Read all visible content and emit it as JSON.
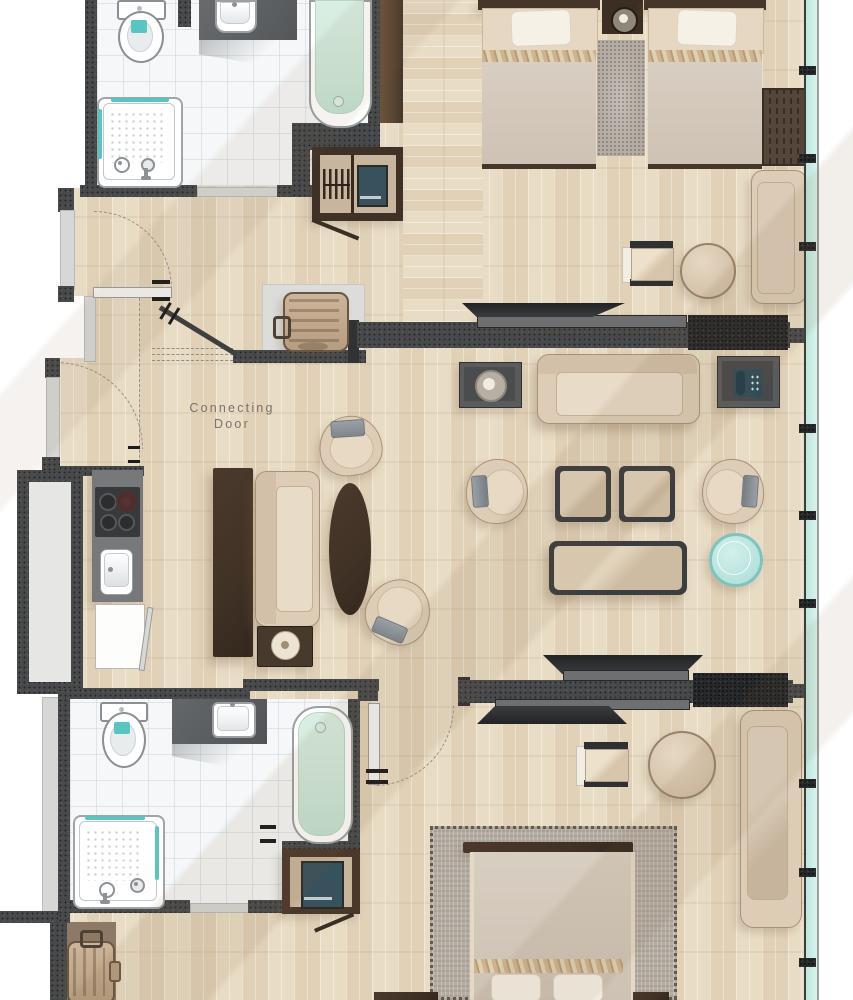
{
  "labels": {
    "connecting_door": {
      "line1": "Connecting",
      "line2": "Door"
    }
  },
  "palette": {
    "floor_wood": "#e9dcc5",
    "tile_white": "#f5f7f8",
    "wall_charcoal": "#47494b",
    "wall_black": "#26282a",
    "wall_light_gray": "#d7d7d5",
    "timber_brown": "#5b4634",
    "furniture_dark_brown": "#413226",
    "furniture_beige": "#ddcdb6",
    "furniture_beige_light": "#e8dbc7",
    "furniture_border_tan": "#a8917b",
    "counter_gray": "#76787a",
    "bathtub_mint": "#cfe8da",
    "teal_accent": "#57c6c0",
    "window_glass": "#cdeee6",
    "rug_gray": "#b4aca3",
    "rug_taupe": "#8d7a66",
    "appliance_teal": "#37515d",
    "label_text": "#7b7166"
  }
}
